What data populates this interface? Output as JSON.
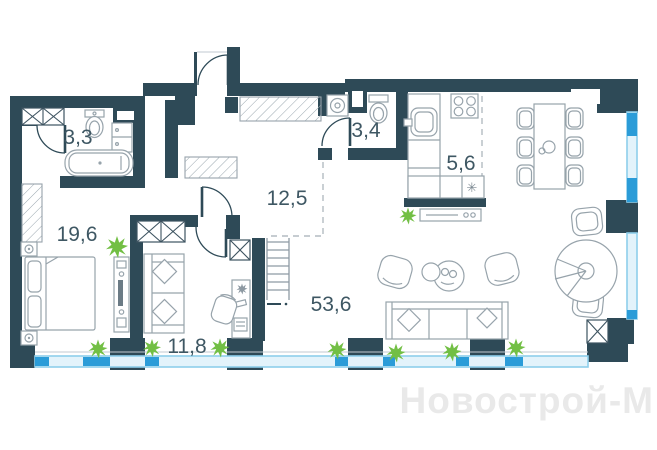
{
  "watermark": "Новострой-М",
  "rooms": [
    {
      "name": "bathroom",
      "area_label": "3,3"
    },
    {
      "name": "bedroom",
      "area_label": "19,6"
    },
    {
      "name": "hallway",
      "area_label": "12,5"
    },
    {
      "name": "wc",
      "area_label": "3,4"
    },
    {
      "name": "kitchen",
      "area_label": "5,6"
    },
    {
      "name": "cabinet-room",
      "area_label": "11,8"
    },
    {
      "name": "living-dining",
      "area_label": "53,6"
    }
  ],
  "symbols": {
    "fridge": "✳"
  },
  "colors": {
    "wall": "#2e4a57",
    "furniture_outline": "#97a3ab",
    "window_light": "#8ecfeb",
    "window_dark": "#2b9cd8",
    "plant_green": "#72bf44",
    "label_text": "#3e5763",
    "watermark_text": "#e9e9e9"
  }
}
